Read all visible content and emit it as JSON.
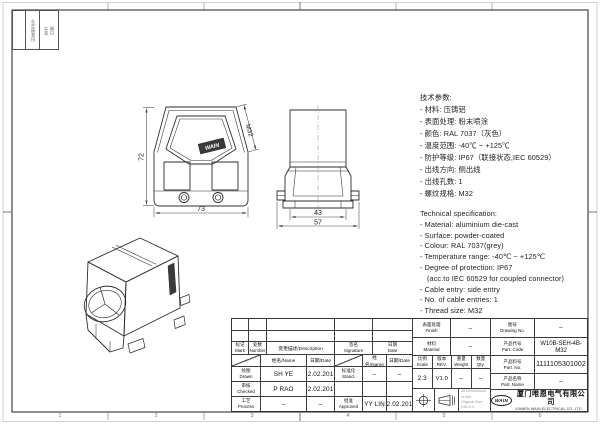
{
  "sheet": {
    "zones_bottom": [
      "1",
      "2",
      "3",
      "4",
      "5",
      "6"
    ],
    "corner_fields": [
      "旧底图总号",
      "签字",
      "日期"
    ]
  },
  "views": {
    "front": {
      "dim_height": "72",
      "dim_width": "73",
      "thread": "M32",
      "sticker": "WAIN"
    },
    "side": {
      "dim_inner": "43",
      "dim_outer": "57"
    }
  },
  "specs_cn": {
    "title": "技术参数:",
    "items": [
      "- 材料: 压铸铝",
      "- 表面处理: 粉末喷涂",
      "- 颜色: RAL 7037（灰色）",
      "- 温度范围: -40℃ ~ +125℃",
      "- 防护等级: IP67（联接状态,IEC 60529）",
      "- 出线方向: 侧出线",
      "- 出线孔数: 1",
      "- 螺纹规格: M32"
    ]
  },
  "specs_en": {
    "title": "Technical specification:",
    "items": [
      "- Material: aluminium die-cast",
      "- Surface: powder-coated",
      "- Colour: RAL 7037(grey)",
      "- Temperature range: -40℃ ~ +125℃",
      "- Degree of protection: IP67",
      "(acc.to IEC 60529 for coupled connector)",
      "- Cable entry: side entry",
      "- No. of cable entries: 1",
      "- Thread size: M32"
    ]
  },
  "title_block": {
    "mark_label": "标记\nMark",
    "number_label": "处数\nNumber",
    "description_label": "变更描述/Description",
    "signature_label": "签名\nSignature",
    "date_label": "日期\nDate",
    "name_col_label": "姓名/Name",
    "date_col_label": "日期/Date",
    "drawn_label": "绘图\nDrawn",
    "checked_label": "审核\nChecked",
    "process_label": "工艺\nProcess",
    "stand_label": "标准化\nStand.",
    "approved_label": "批准\nApproved",
    "drawn_name": "SH YE",
    "drawn_date": "22.02.2017",
    "checked_name": "P RAO",
    "checked_date": "22.02.2017",
    "process_name": "–",
    "process_date": "–",
    "stand_name": "–",
    "stand_date": "–",
    "approved_name": "YY LIN",
    "approved_date": "22.02.2017",
    "finish_label": "表面处理\nFinish",
    "finish_value": "–",
    "material_label": "材料\nMaterial",
    "material_value": "–",
    "scale_label": "比例\nScale",
    "scale_value": "2:3",
    "rev_label": "版本\nREV.",
    "rev_value": "V1.0",
    "weight_label": "重量\nWeight",
    "weight_value": "–",
    "qty_label": "数量\nQty.",
    "qty_value": "–",
    "drawing_no_label": "图号\nDrawing No.",
    "drawing_no_value": "–",
    "part_code_label": "产品代号\nPart. Code",
    "part_code_value": "W10B-SEH-4B-M32",
    "part_no_label": "产品料号\nPart. No.",
    "part_no_value": "1111105301002",
    "part_name_label": "产品名称\nPart. Name",
    "part_name_value": "–"
  },
  "company": {
    "logo": "WAIN",
    "name_cn": "厦门唯恩电气有限公司",
    "name_en": "XIAMEN WAIN ELECTRICAL CO.,LTD"
  },
  "notes": {
    "dimensions": "All Dimensions in mm",
    "size": "Original Size DIN A 4"
  }
}
